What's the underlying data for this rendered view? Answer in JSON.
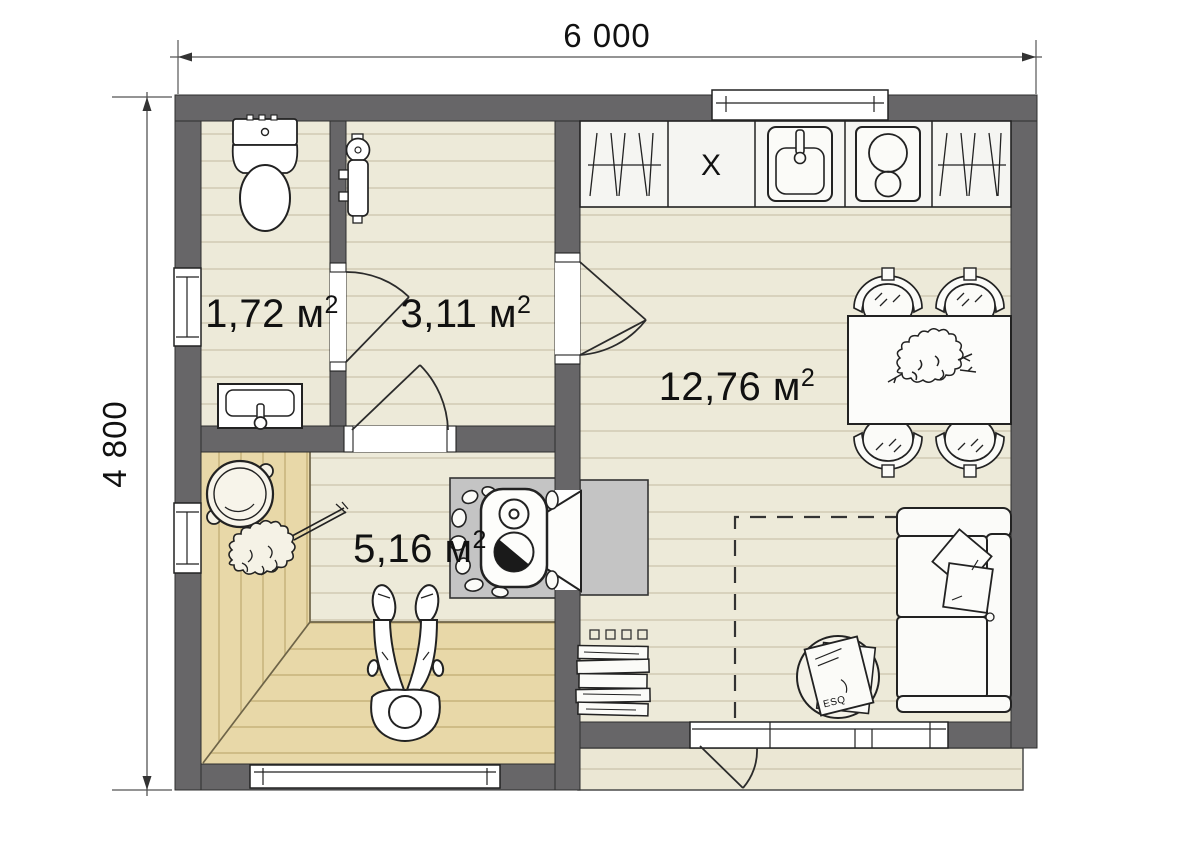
{
  "dimensions": {
    "width": "6 000",
    "height": "4 800"
  },
  "rooms": {
    "bathroom": {
      "area": "1,72 м",
      "sup": "2"
    },
    "hall": {
      "area": "3,11 м",
      "sup": "2"
    },
    "living_kitchen": {
      "area": "12,76 м",
      "sup": "2"
    },
    "sauna": {
      "area": "5,16 м",
      "sup": "2"
    }
  },
  "kitchen": {
    "cabinet_label": "X"
  },
  "coffee_table": {
    "magazine_title": "ESQ"
  },
  "fixtures": [
    "toilet",
    "washbasin",
    "water-heater",
    "kitchen-cabinet",
    "kitchen-sink",
    "cooktop",
    "dining-table",
    "chair",
    "plant",
    "sofa",
    "pillow",
    "coffee-table",
    "magazine",
    "book-stack",
    "sauna-stove",
    "stove-stones",
    "bucket",
    "sauna-whisk",
    "person-lying",
    "window",
    "door",
    "terrace"
  ],
  "colors": {
    "wall": "#676668",
    "floor": "#edead9",
    "floor_line": "#d2cdb6",
    "wood_bench": "#e8d8a8",
    "wood_line": "#c9b67e",
    "stove_platform": "#c4c4c4",
    "outline": "#222222"
  }
}
